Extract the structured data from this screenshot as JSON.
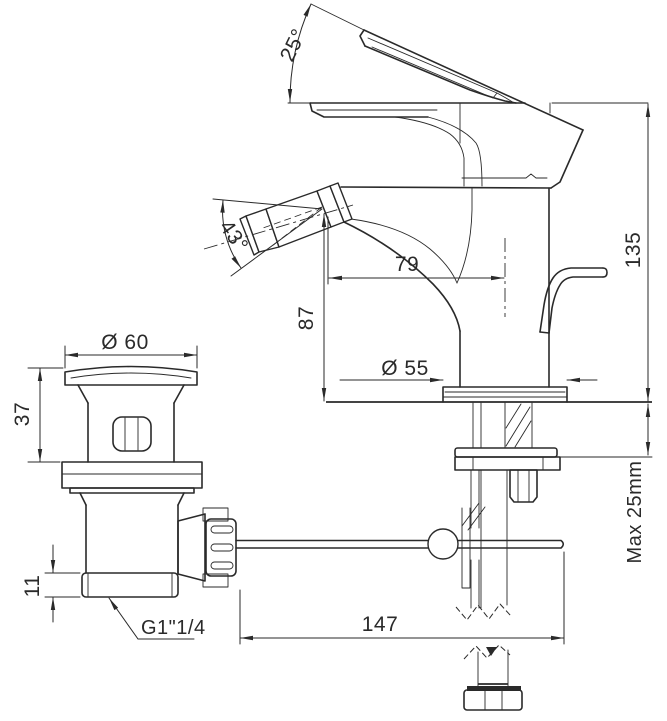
{
  "drawing": {
    "title": "Bidet mixer with pop-up waste - dimensioned technical drawing",
    "dims": {
      "handle_angle": "25°",
      "spray_angle": "43°",
      "spout_reach": "79",
      "spout_height": "87",
      "total_height": "135",
      "base_diameter": "Ø 55",
      "waste_flange_diameter": "Ø 60",
      "waste_upper_height": "37",
      "waste_collar_height": "11",
      "waste_thread": "G1\"1/4",
      "rod_length": "147",
      "max_deck_thickness": "Max 25mm"
    }
  }
}
